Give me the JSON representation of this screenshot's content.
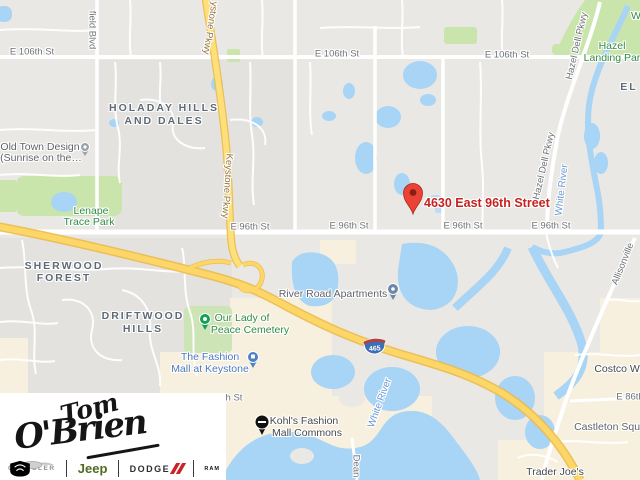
{
  "colors": {
    "map_background": "#e9e8e4",
    "water": "#a8d4f5",
    "park_green": "#c9e5ab",
    "commercial_beige": "#f7f0df",
    "highway_yellow": "#fcd667",
    "marker_red": "#ea4335",
    "address_red": "#c5221f",
    "jeep_green": "#506b21",
    "dodge_red": "#cc2229"
  },
  "map": {
    "address_marker": "4630 East 96th Street",
    "route_shield": "465",
    "streets": {
      "e106": "E 106th St",
      "e96": "E 96th St",
      "e86": "E 86th",
      "h_st": "h St",
      "field_blvd": "field Blvd",
      "keystone_cut": "ystone Pkwy",
      "keystone": "Keystone Pkwy",
      "hazel_dell": "Hazel Dell Pkwy",
      "allisonville": "Allisonville",
      "dean": "Dean"
    },
    "areas": {
      "holaday_1": "HOLADAY HILLS",
      "holaday_2": "AND DALES",
      "sherwood_1": "SHERWOOD",
      "sherwood_2": "FOREST",
      "driftwood_1": "DRIFTWOOD",
      "driftwood_2": "HILLS",
      "el": "EL",
      "w": "W"
    },
    "parks": {
      "lenape_1": "Lenape",
      "lenape_2": "Trace Park",
      "hazel_landing_1": "Hazel",
      "hazel_landing_2": "Landing Par",
      "cemetery_1": "Our Lady of",
      "cemetery_2": "Peace Cemetery"
    },
    "water_labels": {
      "white_river": "White River"
    },
    "pois": {
      "old_town_1": "Old Town Design",
      "old_town_2": "(Sunrise on the…",
      "river_road": "River Road Apartments",
      "fashion_1": "The Fashion",
      "fashion_2": "Mall at Keystone",
      "kohls_1": "Kohl's Fashion",
      "kohls_2": "Mall Commons",
      "costco": "Costco Wh",
      "castleton": "Castleton Squa",
      "trader_joes": "Trader Joe's"
    }
  },
  "logo": {
    "name_first": "Tom",
    "name_last": "O'Brien",
    "brands": {
      "chrysler": "CHRYSLER",
      "jeep": "Jeep",
      "dodge": "DODGE",
      "ram": "RAM"
    }
  }
}
